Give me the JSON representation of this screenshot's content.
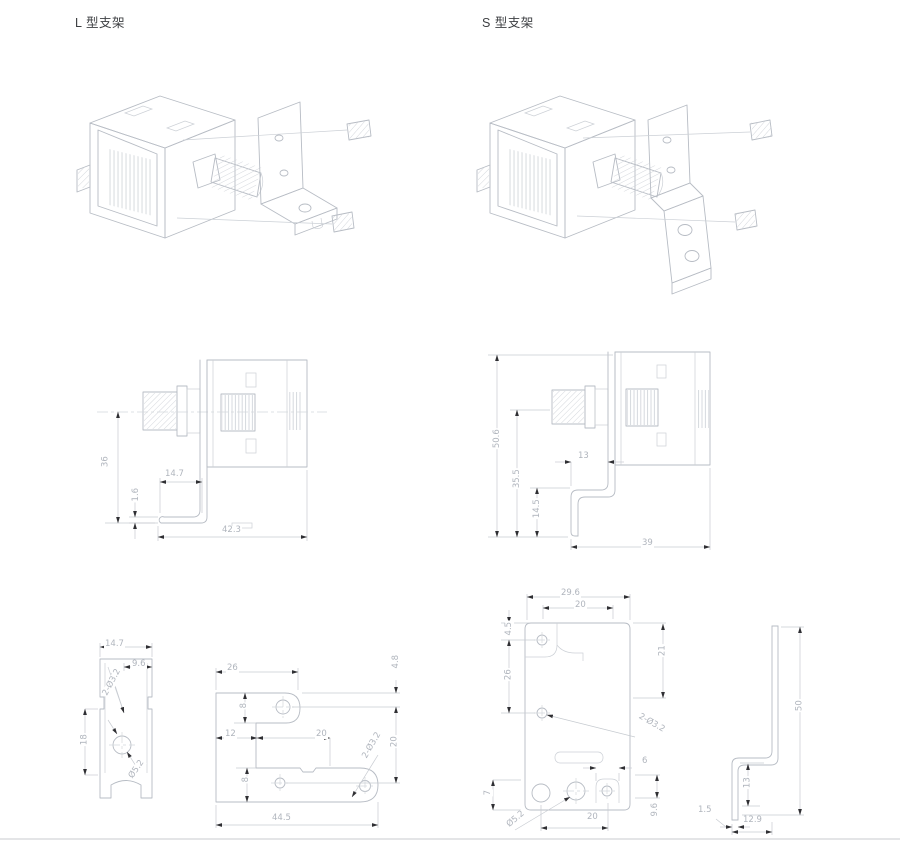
{
  "colors": {
    "background": "#ffffff",
    "line_art": "#b7bcc4",
    "dimension_line": "#c7cbd1",
    "dimension_text": "#b0b5bd",
    "arrowhead": "#2f2f33",
    "title_text": "#3d3f42"
  },
  "l": {
    "title": "L 型支架",
    "mid_view": {
      "height": "36",
      "thickness": "1.6",
      "flange_length": "14.7",
      "total_depth": "42.3"
    },
    "side_view": {
      "width": "14.7",
      "offset": "9.6",
      "height": "18",
      "hole_callout": "2-Ø3.2",
      "center_hole": "Ø5.2"
    },
    "flat_view": {
      "top_width": "26",
      "edge_to_hole": "4.8",
      "tab_width": "8",
      "step": "12",
      "slot_span": "20",
      "hole_pitch": "20",
      "lower_width": "8",
      "total_length": "44.5",
      "hole_callout": "2-Ø3.2"
    }
  },
  "s": {
    "title": "S 型支架",
    "mid_view": {
      "total_height": "50.6",
      "mid_height": "35.5",
      "lower_height": "14.5",
      "step": "13",
      "total_depth": "39"
    },
    "flat_view": {
      "total_width": "29.6",
      "hole_pitch": "20",
      "edge_offset": "4.5",
      "hole_gap": "26",
      "right_height": "21",
      "hole_callout": "2-Ø3.2",
      "tab_width": "6",
      "center_hole": "Ø5.2",
      "bottom_pitch": "20",
      "left_offset": "7",
      "right_offset": "9.6"
    },
    "side_view": {
      "height": "50",
      "foot_height": "13",
      "thickness": "1.5",
      "foot_depth": "12.9"
    }
  }
}
